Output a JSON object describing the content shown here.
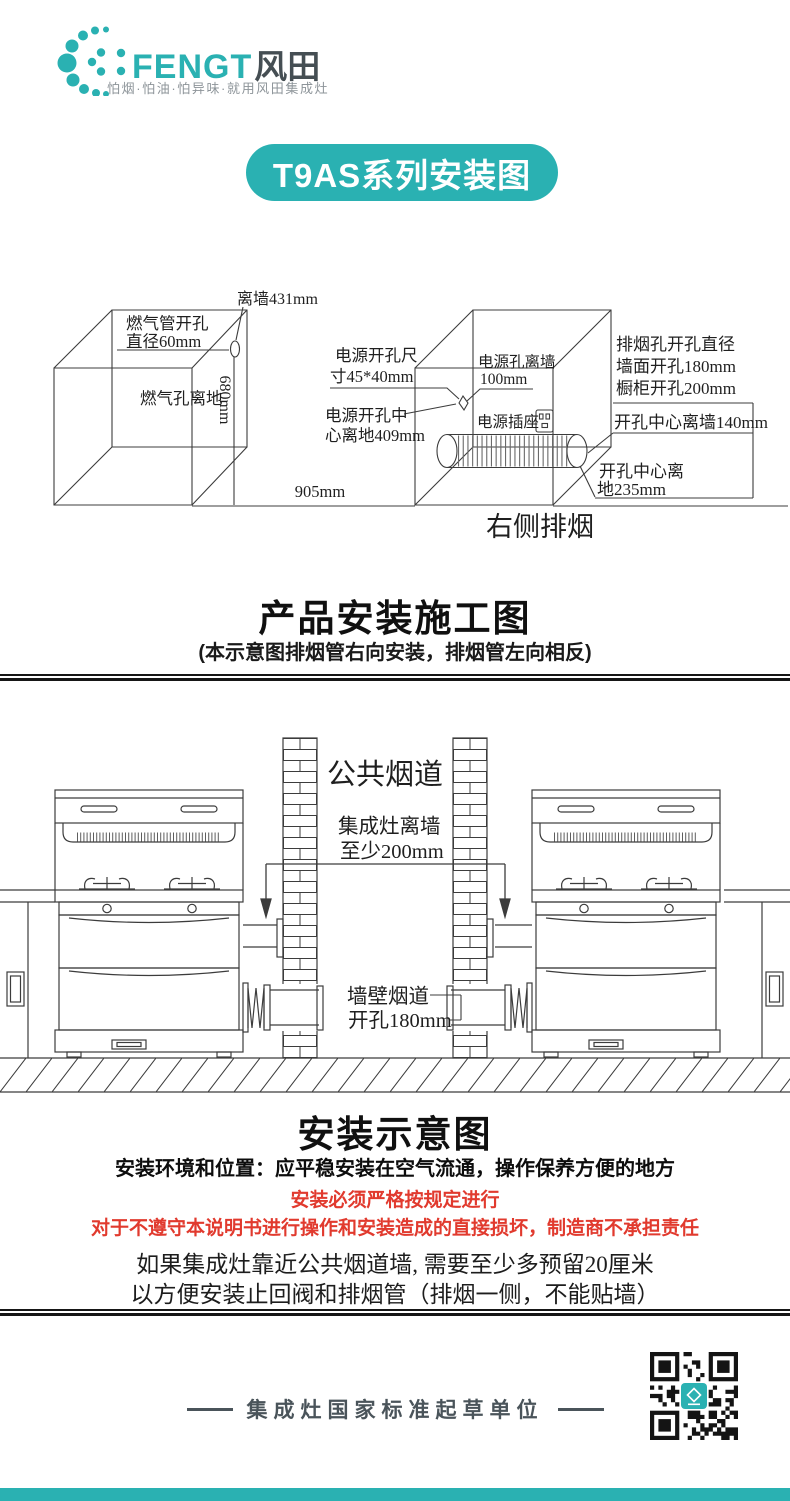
{
  "colors": {
    "teal": "#2ab1b2",
    "red": "#e13a2e",
    "dark_text": "#454e53",
    "gray_text": "#8d9499",
    "line": "#3c3c3c"
  },
  "logo": {
    "en": "FENGT",
    "cn": "风田",
    "tagline": "怕烟·怕油·怕异味·就用风田集成灶"
  },
  "banner": {
    "title": "T9AS系列安装图"
  },
  "construction": {
    "title": "产品安装施工图",
    "subtitle": "(本示意图排烟管右向安装，排烟管左向相反)",
    "left_box": {
      "wall431": "离墙431mm",
      "gas1": "燃气管开孔",
      "gas2": "直径60mm",
      "gas_floor": "燃气孔离地",
      "h680": "680mm",
      "w905": "905mm"
    },
    "right_box": {
      "pw1": "电源开孔尺",
      "pw2": "寸45*40mm",
      "pc1": "电源开孔中",
      "pc2": "心离地409mm",
      "pwall1": "电源孔离墙",
      "pwall2": "100mm",
      "socket": "电源插座",
      "vent1": "排烟孔开孔直径",
      "vent2": "墙面开孔180mm",
      "vent3": "橱柜开孔200mm",
      "vc_wall": "开孔中心离墙140mm",
      "vc_floor1": "开孔中心离",
      "vc_floor2": "地235mm",
      "caption": "右侧排烟"
    }
  },
  "installation": {
    "title": "安装示意图",
    "chimney": "公共烟道",
    "dist1": "集成灶离墙",
    "dist2": "至少200mm",
    "duct1": "墙壁烟道",
    "duct2": "开孔180mm"
  },
  "notes": {
    "env": "安装环境和位置：应平稳安装在空气流通，操作保养方便的地方",
    "warn1": "安装必须严格按规定进行",
    "warn2": "对于不遵守本说明书进行操作和安装造成的直接损坏，制造商不承担责任",
    "note1": "如果集成灶靠近公共烟道墙, 需要至少多预留20厘米",
    "note2": "以方便安装止回阀和排烟管（排烟一侧，不能贴墙）"
  },
  "footer": {
    "dash": "——",
    "slogan": "集成灶国家标准起草单位"
  }
}
